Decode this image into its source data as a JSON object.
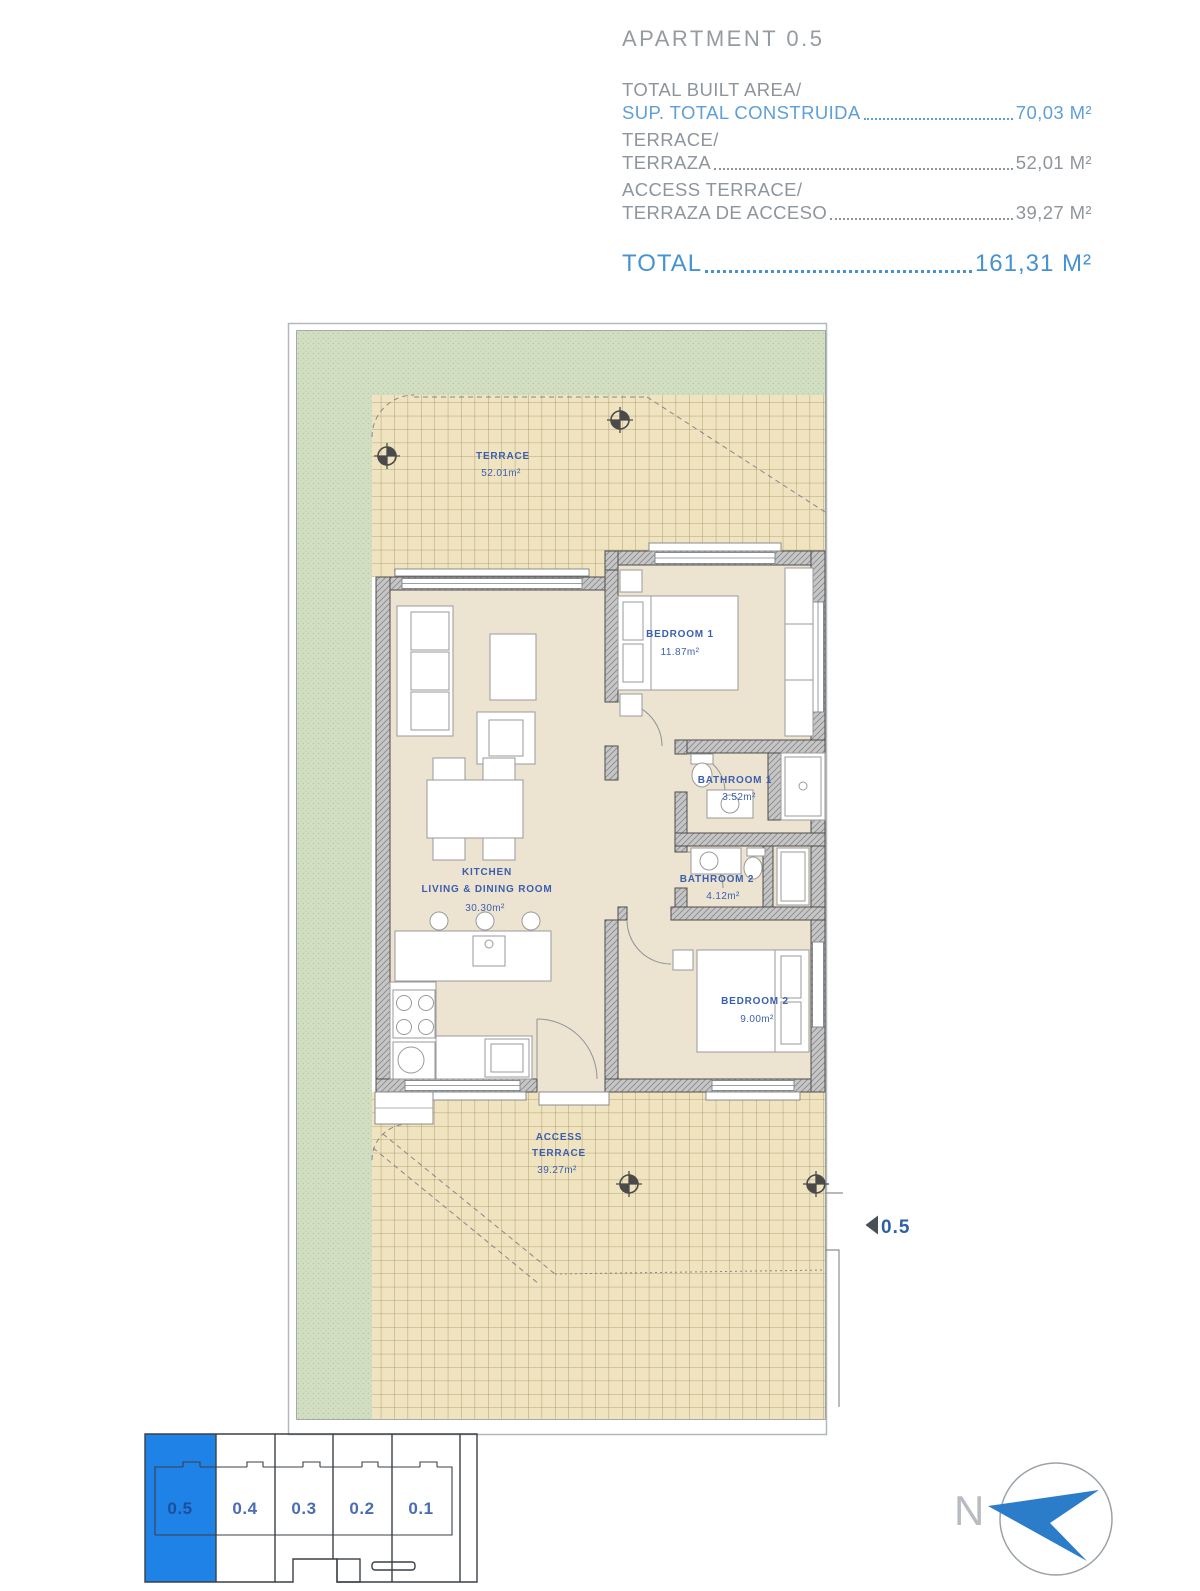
{
  "header": {
    "title": "APARTMENT 0.5",
    "rows": [
      {
        "label_top": "TOTAL BUILT AREA/",
        "label_bottom": "SUP. TOTAL CONSTRUIDA",
        "value": "70,03 M²"
      },
      {
        "label_top": "TERRACE/",
        "label_bottom": "TERRAZA",
        "value": "52,01 M²"
      },
      {
        "label_top": "ACCESS TERRACE/",
        "label_bottom": "TERRAZA DE ACCESO",
        "value": "39,27 M²"
      }
    ],
    "total_label": "TOTAL",
    "total_value": "161,31 M²"
  },
  "plan": {
    "rooms": {
      "terrace": {
        "name": "TERRACE",
        "area": "52.01m²"
      },
      "bedroom1": {
        "name": "BEDROOM 1",
        "area": "11.87m²"
      },
      "bathroom1": {
        "name": "BATHROOM 1",
        "area": "3.52m²"
      },
      "bathroom2": {
        "name": "BATHROOM 2",
        "area": "4.12m²"
      },
      "kitchen": {
        "name_line1": "KITCHEN",
        "name_line2": "LIVING & DINING ROOM",
        "area": "30.30m²"
      },
      "bedroom2": {
        "name": "BEDROOM 2",
        "area": "9.00m²"
      },
      "access_terrace": {
        "name_line1": "ACCESS",
        "name_line2": "TERRACE",
        "area": "39.27m²"
      }
    },
    "unit_marker": "0.5"
  },
  "minimap": {
    "selected": "0.5",
    "units": [
      {
        "id": "0.5"
      },
      {
        "id": "0.4"
      },
      {
        "id": "0.3"
      },
      {
        "id": "0.2"
      },
      {
        "id": "0.1"
      }
    ]
  },
  "compass": {
    "label": "N"
  },
  "colors": {
    "header_gray": "#8e959c",
    "header_blue": "#5f9fd8",
    "total_blue": "#4792d2",
    "plan_label_blue": "#3b5fae",
    "selected_unit_blue": "#1e82e6",
    "tile_fill": "#f0e3bf",
    "grass_green": "#d3dfc3",
    "wall_gray": "#c6c6c6"
  }
}
